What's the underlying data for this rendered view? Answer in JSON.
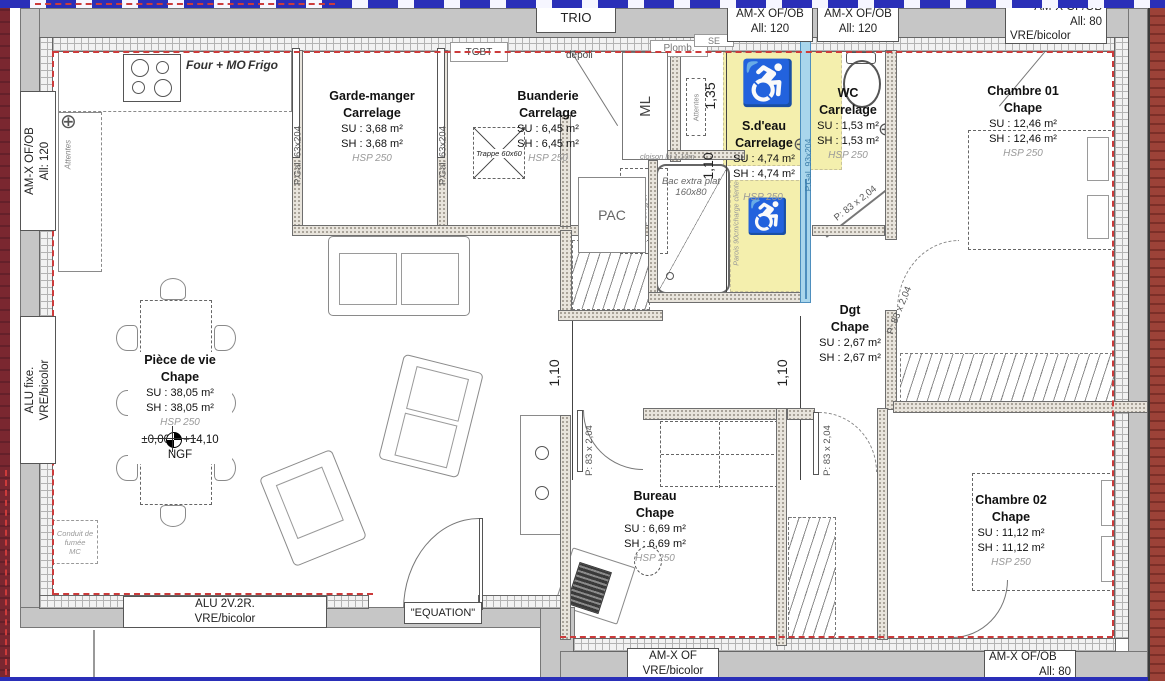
{
  "rooms": {
    "garde_manger": {
      "name": "Garde-manger",
      "floor": "Carrelage",
      "su": "SU : 3,68 m²",
      "sh": "SH : 3,68 m²",
      "hsp": "HSP 250"
    },
    "buanderie": {
      "name": "Buanderie",
      "floor": "Carrelage",
      "su": "SU : 6,45 m²",
      "sh": "SH : 6,45 m²",
      "hsp": "HSP 250"
    },
    "sdeau": {
      "name": "S.d'eau",
      "floor": "Carrelage",
      "su": "SU : 4,74 m²",
      "sh": "SH : 4,74 m²",
      "hsp": "HSP 250"
    },
    "wc": {
      "name": "WC",
      "floor": "Carrelage",
      "su": "SU : 1,53 m²",
      "sh": "SH : 1,53 m²",
      "hsp": "HSP 250"
    },
    "chambre01": {
      "name": "Chambre 01",
      "floor": "Chape",
      "su": "SU : 12,46 m²",
      "sh": "SH : 12,46 m²",
      "hsp": "HSP 250"
    },
    "piece_de_vie": {
      "name": "Pièce de vie",
      "floor": "Chape",
      "su": "SU : 38,05 m²",
      "sh": "SH : 38,05 m²",
      "hsp": "HSP 250",
      "ngf": "±0,00 = +14,10 NGF"
    },
    "dgt": {
      "name": "Dgt",
      "floor": "Chape",
      "su": "SU : 2,67 m²",
      "sh": "SH : 2,67 m²"
    },
    "bureau": {
      "name": "Bureau",
      "floor": "Chape",
      "su": "SU : 6,69 m²",
      "sh": "SH : 6,69 m²",
      "hsp": "HSP 250"
    },
    "chambre02": {
      "name": "Chambre 02",
      "floor": "Chape",
      "su": "SU : 11,12 m²",
      "sh": "SH : 11,12 m²",
      "hsp": "HSP 250"
    }
  },
  "openings": {
    "trio": "TRIO",
    "amx_ofob": "AM-X OF/OB",
    "all_120": "All: 120",
    "all_80": "All: 80",
    "vre_bicolor": "VRE/bicolor",
    "alu_fixe": "ALU fixe.",
    "alu_2v2r": "ALU 2V.2R.",
    "equation": "\"EQUATION\"",
    "amx_of": "AM-X OF"
  },
  "doors": {
    "pgal_63": "P.Gal. 63x204",
    "pgal_93": "P.Gal. 93x204",
    "p83": "P: 83 x 2,04"
  },
  "dims": {
    "d_135": "1,35",
    "d_110": "1,10"
  },
  "equipment": {
    "four_mo": "Four + MO",
    "frigo": "Frigo",
    "tgbt": "TGBT",
    "depoli": "dépoli",
    "plomb": "Plomb.",
    "se": "SE",
    "ml": "ML",
    "congel": "Congél",
    "attentes": "Attentes",
    "pac": "PAC",
    "trappe": "Trappe 60x60",
    "bac_line1": "Bac extra plat",
    "bac_line2": "160x80",
    "cloison": "cloison ht 1,10m",
    "parois": "Parois 90cm/charge cliente",
    "conduit_line1": "Conduit de fumée",
    "conduit_line2": "MC"
  },
  "colors": {
    "room_highlight": "#f4efad",
    "sliding_door": "#a9d6ec",
    "wall_gray": "#c6c6c6",
    "red_dash": "#cc3b3b",
    "brick": "#8d3b34",
    "frame_blue": "#2a2fb8"
  }
}
